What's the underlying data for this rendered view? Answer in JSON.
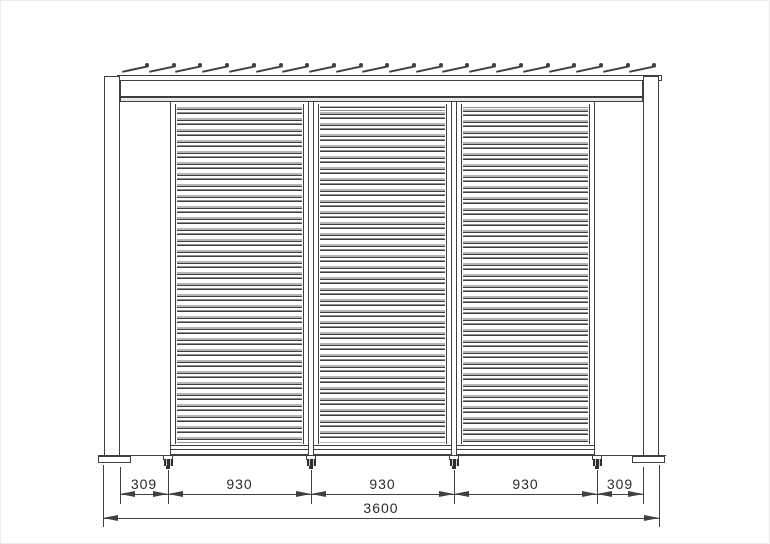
{
  "drawing": {
    "kind": "louvered-screen-elevation"
  },
  "dims": {
    "row1": [
      "309",
      "930",
      "930",
      "930",
      "309"
    ],
    "total": "3600"
  },
  "structure": {
    "panel_count": 3,
    "roof_louver_count": 20,
    "slats_per_panel": 31,
    "feet_count": 4
  },
  "colors": {
    "line": "#3f3f3f",
    "text": "#2b2b2b"
  }
}
